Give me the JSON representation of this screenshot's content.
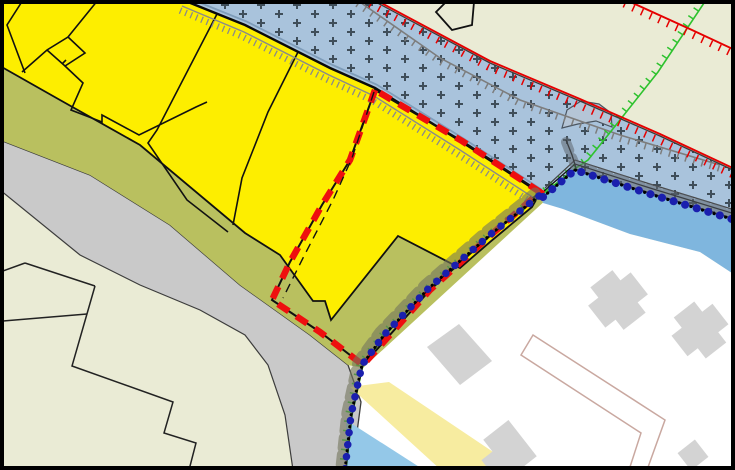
{
  "map": {
    "kind": "cadastral-gis-map-viewport",
    "colors": {
      "parcel_yellow": "#fdee00",
      "verge_olive": "#b9c05f",
      "terrain_beige": "#eaebd5",
      "road_gray": "#c9c9c9",
      "hatch_blue": "#a9c3dc",
      "hatch_cross": "#3f4e5a",
      "water_blue": "#7fb6de",
      "water_light": "#94c8e8",
      "path_band_yellow": "#f7eca0",
      "building_gray": "#d3d3d3",
      "open_area_white": "#ffffff",
      "selection_red": "#ee0f0f",
      "hachure_red": "#e60000",
      "hachure_green": "#2ec22e",
      "hachure_gray": "#7d7d7d",
      "survey_dot_navy": "#1a1fae",
      "survey_dot_olive": "#73745c",
      "line_black": "#111111",
      "boundary_bluegray": "#7f9dba",
      "path_outline_pink": "#c9a8a0",
      "bump_fill": "#b5c5d6",
      "frame_black": "#000000"
    },
    "layers": [
      {
        "id": "terrain",
        "label": "terrain-background"
      },
      {
        "id": "parcels",
        "label": "yellow-parcels"
      },
      {
        "id": "verge",
        "label": "olive-verge-strip"
      },
      {
        "id": "road",
        "label": "road-band"
      },
      {
        "id": "hatched-zone",
        "label": "cross-hatched-overlay-zone"
      },
      {
        "id": "water",
        "label": "watercourse"
      },
      {
        "id": "open-area",
        "label": "open-white-area"
      },
      {
        "id": "buildings",
        "label": "gray-buildings"
      },
      {
        "id": "selection",
        "label": "red-dashed-selection-boundary"
      },
      {
        "id": "survey-chain",
        "label": "surveyed-boundary-point-chain"
      },
      {
        "id": "hachures",
        "label": "red-green-gray-hachure-lines"
      }
    ]
  }
}
